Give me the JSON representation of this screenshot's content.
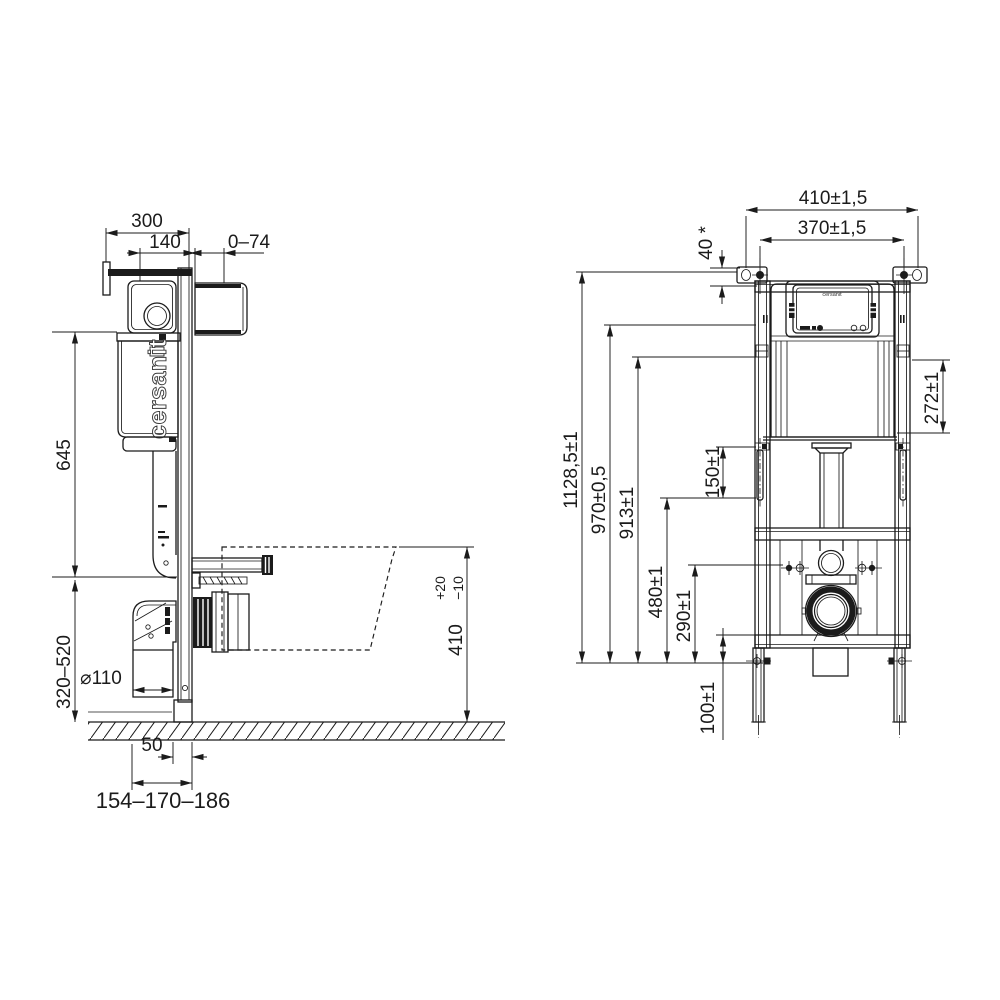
{
  "drawing": {
    "brand_side": "cersanit",
    "brand_panel": "cersanit",
    "side_view": {
      "dim_overall_depth": "300",
      "dim_cistern_depth": "140",
      "dim_wall_gap": "0–74",
      "dim_cistern_span": "645",
      "dim_outlet_height": "320–520",
      "dim_drain_diameter": "⌀110",
      "dim_leg_offset": "50",
      "dim_outlet_distance": "154–170–186",
      "dim_bowl_height": "410",
      "dim_bowl_tol_plus": "+20",
      "dim_bowl_tol_minus": "−10"
    },
    "front_view": {
      "dim_frame_width": "410±1,5",
      "dim_fixing_centres": "370±1,5",
      "dim_bracket_offset": "40 *",
      "dim_total_height": "1128,5±1",
      "dim_height_970": "970±0,5",
      "dim_height_913": "913±1",
      "dim_stud_length": "150±1",
      "dim_height_480": "480±1",
      "dim_height_290": "290±1",
      "dim_leg_adjust": "100±1",
      "dim_tank_height": "272±1"
    }
  }
}
